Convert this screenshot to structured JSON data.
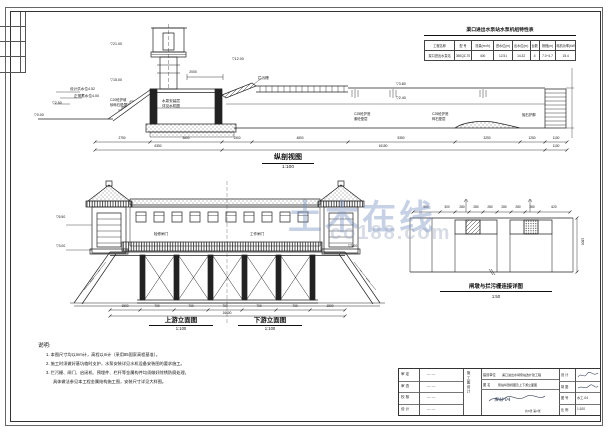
{
  "watermark": {
    "main": "土木在线",
    "sub": "co188.com"
  },
  "spec_table": {
    "title": "渠口进出水泵站水泵机组特性表",
    "headers": [
      "工程名称",
      "型 号",
      "流量(m³/h)",
      "进水位(m)",
      "出水位(m)",
      "台数",
      "扬程(m)",
      "电机功率(kW)"
    ],
    "row": [
      "渠口进出水泵站",
      "350QZ-70",
      "400",
      "12.51",
      "14.32",
      "4",
      "7.0~4.7",
      "15.4"
    ]
  },
  "section": {
    "caption": "纵剖视图",
    "scale": "1:100",
    "marks": {
      "tower_top": "▽21.00",
      "tower_mid": "▽15.00",
      "deck": "▽12.00",
      "flood": "设计洪水位4.52",
      "normal": "正常蓄水位4.00",
      "m250": "▽2.50",
      "m000": "▽0.00",
      "wl_high": "▽3.80",
      "wl_low": "▽2.40"
    },
    "labels": {
      "slope1": "C20砼护坡",
      "slope2": "砂砾石垫层",
      "pump1": "水泵安装层",
      "pump2": "详见水机图",
      "rack": "拦污栅",
      "floor_a1": "C25砼护底",
      "floor_a2": "素砼垫层",
      "floor_b1": "C25砼护底",
      "floor_b2": "碎石垫层",
      "riprap": "抛石护脚",
      "dim_top": "2000"
    },
    "dims_row1": [
      "2750",
      "3600",
      "1500",
      "4800",
      "5350",
      "3250",
      "1250",
      "1100"
    ],
    "dims_row2": [
      "6350",
      "16150",
      "1100"
    ]
  },
  "elevation": {
    "caption_left": "上游立面图",
    "scale_left": "1:100",
    "caption_right": "下游立面图",
    "scale_right": "1:100",
    "labels": {
      "gate_left": "检修闸门",
      "gate_right": "工作闸门"
    },
    "marks": {
      "left_top": "▽6.50",
      "left_base": "▽3.00",
      "right_base": "▽3.00"
    },
    "dims_row1": [
      "1500",
      "700",
      "700",
      "700",
      "700",
      "700",
      "1500"
    ],
    "dim_total": "16600"
  },
  "detail": {
    "caption": "闸墩与拦污栅连接详图",
    "scale": "1:50",
    "dims": [
      "550",
      "300",
      "280",
      "280",
      "280",
      "280",
      "280",
      "280",
      "620"
    ],
    "dim_right": "1600"
  },
  "notes": {
    "heading": "说明:",
    "items": [
      "1. 本图尺寸均以mm计，高程以m计（采用85国家高程基准）。",
      "2. 施工时须做好基坑临时支护，水泵安装详见水机设备安装图的要求施工。",
      "3. 拦污栅、闸门、启闭机、预埋件、栏杆等金属构件均须做好除锈防腐处理，",
      "具体做法参见本工程金属结构施工图，安装尺寸详见大样图。"
    ]
  },
  "titleblock": {
    "rows_left": [
      {
        "label": "审 定",
        "sig": "— —"
      },
      {
        "label": "审 查",
        "sig": "— —"
      },
      {
        "label": "校 核",
        "sig": "— —"
      },
      {
        "label": "设 计",
        "sig": "— —"
      }
    ],
    "stage": "施工图设计",
    "owner_label": "建设单位",
    "project_value": "渠口进出水闸泵站改扩建工程",
    "drawing_label": "图 名",
    "drawing_value": "泵站纵剖视图及上下游立面图",
    "pages": "共4张 第2张",
    "drawing_note": "泵站-04",
    "rows_right": [
      {
        "label": "设 计",
        "value": ""
      },
      {
        "label": "制 图",
        "value": ""
      },
      {
        "label": "图 号",
        "value": "水工-04"
      },
      {
        "label": "比 例",
        "value": "1:100"
      }
    ]
  }
}
